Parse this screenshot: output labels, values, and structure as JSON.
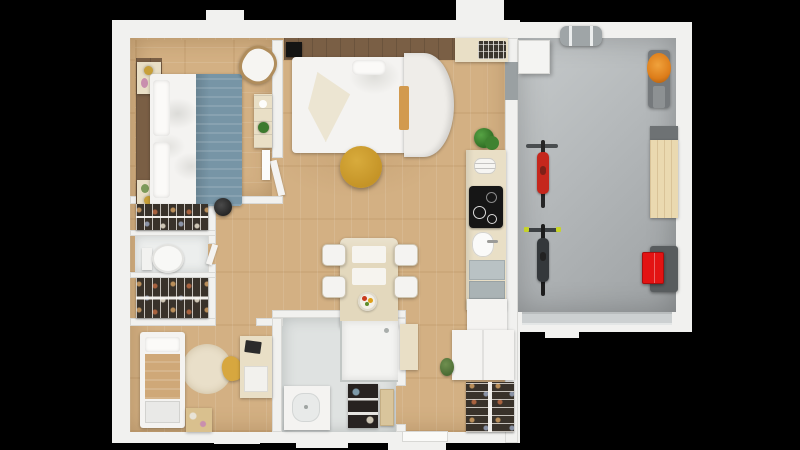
{
  "scene": {
    "description": "3D top-down render of an apartment floor plan with attached garage on black background",
    "background": "#000000"
  },
  "palette": {
    "bg": "#000000",
    "wall": "#f1f1ef",
    "wallEdge": "#d9d9d6",
    "wood": "#d3b083",
    "walnut": "#7a5f45",
    "garage": "#b4b8ba",
    "garageDark": "#9da1a3",
    "bath": "#dfe2e1",
    "wc": "#eceeed",
    "closet": "#39322a",
    "white": "#f4f3f1",
    "cream": "#e9dfc6",
    "blue": "#7795a6",
    "mustard": "#c59427",
    "orangeMower": "#dd7d1a",
    "redToolbox": "#e31313",
    "bikeRed": "#c5271d",
    "green": "#3c7a2e",
    "tan": "#cfa878",
    "doorGray": "#9aa0a2",
    "cooktopBlack": "#161616"
  },
  "rooms": [
    {
      "id": "bedroom-main"
    },
    {
      "id": "living-area"
    },
    {
      "id": "kitchen"
    },
    {
      "id": "wc"
    },
    {
      "id": "kids-room"
    },
    {
      "id": "bathroom"
    },
    {
      "id": "entry-hallway"
    },
    {
      "id": "garage"
    }
  ],
  "objects": [
    "double-bed-blue-blanket",
    "bedside-tables-with-lamps",
    "corner-chair",
    "dresser-with-plant",
    "wall-tv",
    "platform-bed-rounded-headboard",
    "mustard-pouf",
    "dining-table-four-chairs",
    "fruit-bowl",
    "cooktop",
    "kitchen-sink",
    "dish-rack",
    "potted-plant",
    "wardrobe-hanging-clothes-top",
    "toilet",
    "wardrobe-hanging-clothes-bottom",
    "single-bed",
    "round-rug",
    "yellow-chair",
    "desk-with-laptop",
    "toy-box",
    "shower",
    "vanity-sink",
    "bathroom-shelf",
    "entry-closet",
    "entry-plant",
    "red-bicycle",
    "black-bicycle",
    "lawn-mower",
    "workbench",
    "red-toolbox-cart",
    "roof-cargo-box",
    "garage-cabinet",
    "garage-door"
  ]
}
